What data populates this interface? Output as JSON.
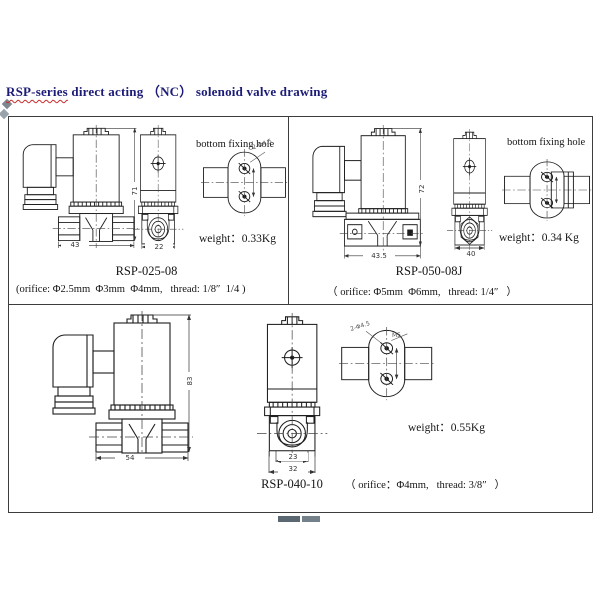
{
  "title": {
    "highlight": "RSP-series",
    "rest": " direct acting （NC） solenoid valve drawing"
  },
  "panels": [
    {
      "model": "RSP-025-08",
      "fixing_hole_label": "bottom fixing hole",
      "weight": "weight：0.33Kg",
      "spec": "(orifice: Φ2.5mm  Φ3mm  Φ4mm,   thread: 1/8″  1/4 )",
      "dims": {
        "width": "43",
        "front_width": "22",
        "height": "71",
        "hole_note": "2-Φ4.5"
      }
    },
    {
      "model": "RSP-050-08J",
      "fixing_hole_label": "bottom fixing  hole",
      "weight": "weight：0.34 Kg",
      "spec": "（ orifice: Φ5mm  Φ6mm,   thread: 1/4″   ）",
      "dims": {
        "width": "43.5",
        "front_width": "40",
        "height": "72"
      }
    },
    {
      "model": "RSP-040-10",
      "weight": "weight：0.55Kg",
      "spec": "（ orifice：Φ4mm,   thread: 3/8″   ）",
      "dims": {
        "width": "54",
        "front_port": "23",
        "front_width": "32",
        "height": "83",
        "hole_note": "2-Φ4.5",
        "hole_note2": "M5"
      }
    }
  ]
}
